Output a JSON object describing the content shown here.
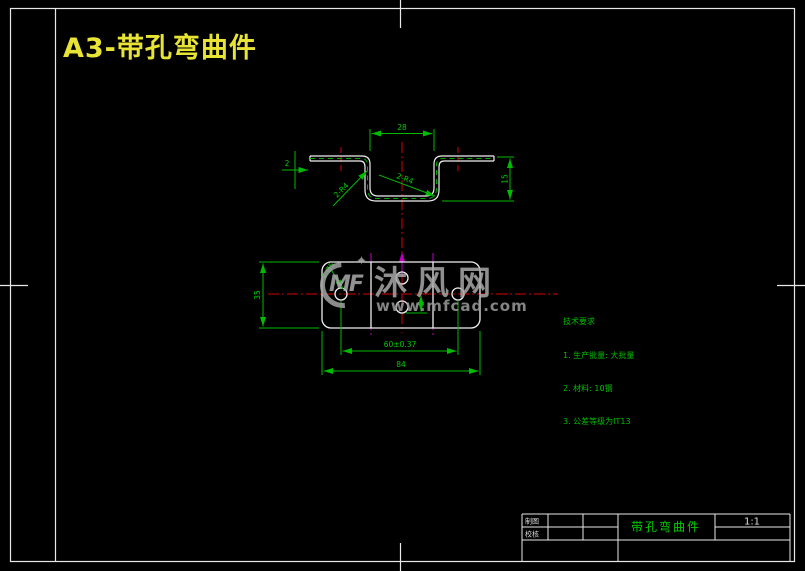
{
  "page": {
    "title": "A3-带孔弯曲件"
  },
  "watermark": {
    "logo_text": "MF",
    "star": "✦",
    "site_name": "沐风网",
    "site_url": "www.mfcad.com"
  },
  "section_view": {
    "dim_top_width": "28",
    "dim_height": "15",
    "dim_thickness": "2",
    "radius_left_label": "2-R4",
    "radius_right_label": "2-R4"
  },
  "plan_view": {
    "hole_callout": "4-Ø5",
    "dim_hole_spacing": "60±0.37",
    "dim_total_width": "84",
    "dim_height": "35"
  },
  "tech_requirements": {
    "title": "技术要求",
    "items": [
      "1. 生产批量: 大批量",
      "2. 材料: 10钢",
      "3. 公差等级为IT13"
    ]
  },
  "title_block": {
    "row1_label": "制图",
    "row2_label": "校核",
    "part_name": "带孔弯曲件",
    "scale": "1:1"
  },
  "colors": {
    "background": "#000000",
    "outline_white": "#efefef",
    "dimension_green": "#00bb00",
    "centerline_red": "#d40000",
    "bend_magenta": "#c000c0",
    "title_yellow": "#e8e435",
    "watermark_gray": "#a8a8a8"
  }
}
